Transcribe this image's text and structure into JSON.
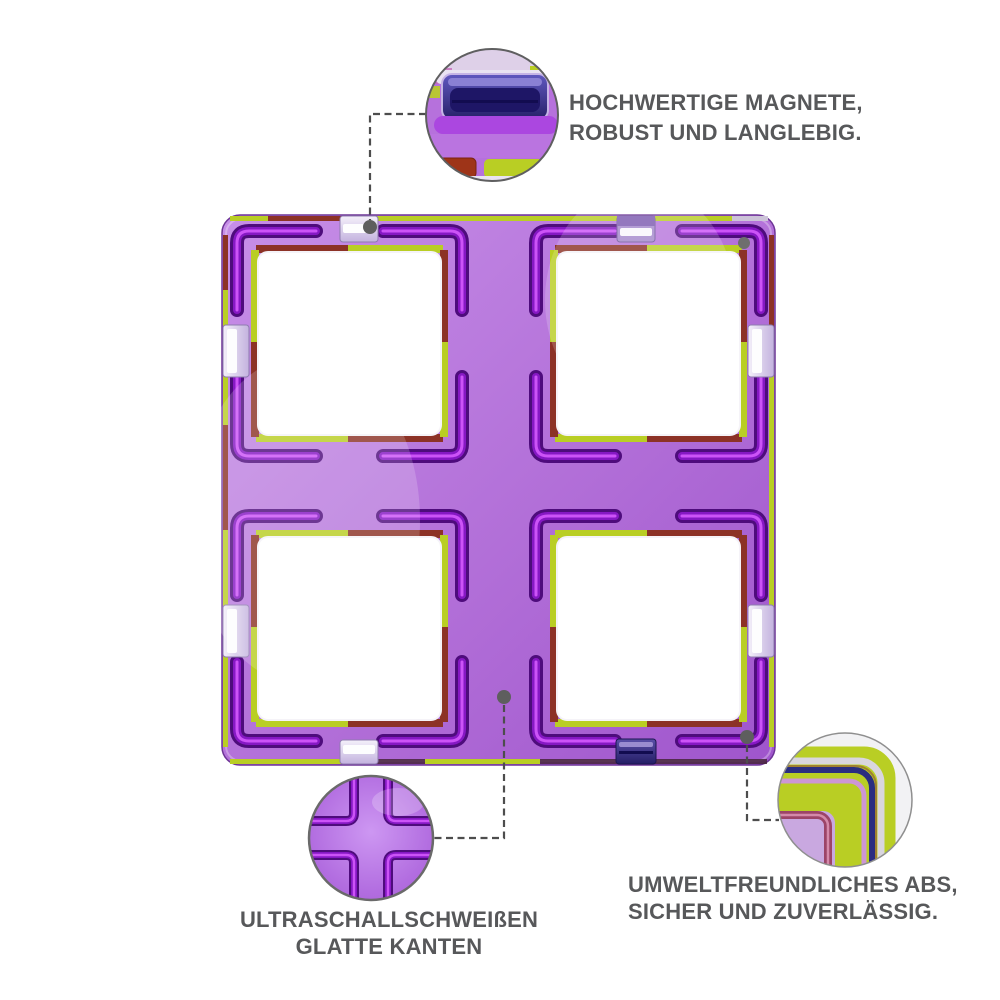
{
  "annotations": {
    "magnets": {
      "line1": "HOCHWERTIGE MAGNETE,",
      "line2": "ROBUST UND LANGLEBIG."
    },
    "welding": {
      "line1": "ULTRASCHALLSCHWEIßEN",
      "line2": "GLATTE KANTEN"
    },
    "abs": {
      "line1": "UMWELTFREUNDLICHES ABS,",
      "line2": "SICHER UND ZUVERLÄSSIG."
    }
  },
  "callouts": [
    {
      "id": "magnet-detail",
      "label": "magnet close-up"
    },
    {
      "id": "weld-detail",
      "label": "weld seam close-up"
    },
    {
      "id": "corner-detail",
      "label": "corner edge close-up"
    }
  ],
  "colors": {
    "body-purple": "#b26fd8",
    "body-light": "#c78fe8",
    "body-deep": "#9f55cc",
    "groove-dark": "#4e0c7c",
    "groove-mid": "#8618c4",
    "groove-hi": "#d056fa",
    "chartreuse": "#b9ce24",
    "maroon": "#8c3226",
    "magnet-navy": "#241e6a",
    "pocket-silver": "#f4f0fa",
    "leader-gray": "#4d4d4d",
    "dot-gray": "#5e5e5e",
    "text-gray": "#57585a",
    "callout-border": "#6a6a6a",
    "window-white": "#ffffff"
  }
}
